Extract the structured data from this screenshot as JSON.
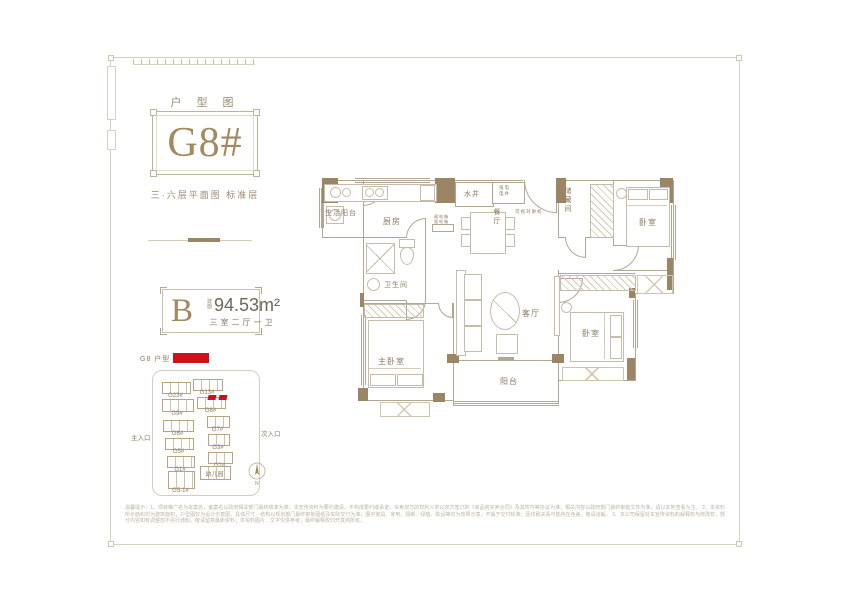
{
  "header": {
    "title": "户 型 图",
    "unit": "G8#",
    "subtitle": "三·六层平面图  标准层"
  },
  "info": {
    "type_letter": "B",
    "area_label_line1": "建",
    "area_label_line2": "面",
    "area_value": "94.53m²",
    "rooms_desc": "三室二厅一卫"
  },
  "colors": {
    "accent_red": "#d0101c",
    "wall_tan": "#9c8565",
    "gold": "#a3895e"
  },
  "siteplan": {
    "legend_label": "G8 户型",
    "entrance_left": "主入口",
    "entrance_right": "次入口",
    "compass": "N",
    "buildings": [
      {
        "label": "G23#",
        "x": 27,
        "y": 30,
        "w": 27,
        "h": 10
      },
      {
        "label": "G13#",
        "x": 58,
        "y": 27,
        "w": 28,
        "h": 10
      },
      {
        "label": "G9#",
        "x": 27,
        "y": 47,
        "w": 30,
        "h": 11
      },
      {
        "label": "G8#",
        "x": 62,
        "y": 45,
        "w": 27,
        "h": 10,
        "hl": true
      },
      {
        "label": "G6#",
        "x": 28,
        "y": 68,
        "w": 29,
        "h": 10
      },
      {
        "label": "G7#",
        "x": 72,
        "y": 64,
        "w": 21,
        "h": 10
      },
      {
        "label": "G5#",
        "x": 30,
        "y": 86,
        "w": 27,
        "h": 10
      },
      {
        "label": "G3#",
        "x": 73,
        "y": 82,
        "w": 20,
        "h": 10
      },
      {
        "label": "G1#",
        "x": 32,
        "y": 104,
        "w": 26,
        "h": 10
      },
      {
        "label": "G2#",
        "x": 73,
        "y": 100,
        "w": 23,
        "h": 10
      },
      {
        "label": "G5-1#",
        "x": 33,
        "y": 119,
        "w": 25,
        "h": 16
      },
      {
        "label": "幼儿园",
        "x": 65,
        "y": 114,
        "w": 29,
        "h": 12,
        "boxed": true
      }
    ]
  },
  "floorplan": {
    "labels": [
      {
        "text": "生活阳台",
        "x": 15,
        "y": 48,
        "fs": 7
      },
      {
        "text": "厨房",
        "x": 73,
        "y": 56,
        "fs": 8
      },
      {
        "text": "水井",
        "x": 154,
        "y": 29,
        "fs": 7
      },
      {
        "text": "强电",
        "x": 189,
        "y": 25,
        "fs": 4.5
      },
      {
        "text": "电井",
        "x": 189,
        "y": 31,
        "fs": 4.5
      },
      {
        "text": "可视对讲机",
        "x": 205,
        "y": 49,
        "fs": 4.5
      },
      {
        "text": "餐厅",
        "x": 181,
        "y": 48,
        "fs": 7,
        "v": true
      },
      {
        "text": "储藏间",
        "x": 252,
        "y": 27,
        "fs": 7,
        "v": true
      },
      {
        "text": "卧室",
        "x": 329,
        "y": 57,
        "fs": 8
      },
      {
        "text": "弱电箱",
        "x": 124,
        "y": 54,
        "fs": 4
      },
      {
        "text": "强电箱",
        "x": 124,
        "y": 59,
        "fs": 4
      },
      {
        "text": "卫生间",
        "x": 74,
        "y": 120,
        "fs": 7
      },
      {
        "text": "客厅",
        "x": 212,
        "y": 148,
        "fs": 8
      },
      {
        "text": "主卧室",
        "x": 68,
        "y": 196,
        "fs": 8
      },
      {
        "text": "卧室",
        "x": 272,
        "y": 168,
        "fs": 8
      },
      {
        "text": "阳台",
        "x": 190,
        "y": 216,
        "fs": 8
      }
    ]
  },
  "disclaimer": {
    "lines": [
      "温馨提示：1、项目推广名为本案名，备案名以政府相关部门最终核准为准；本宣传资料为要约邀请，不构成要约或承诺，买卖双方的权利义务以双方签订的《商品房买卖合同》及其附件等协议为准；相关内容以政府部门最终审批文件为准，请以实地查看为主。",
      "2、本资料所示面积均为建筑面积，户型图仅为设计示意图，具体尺寸、结构以规划部门最终审批图纸及实际交付为准；图中家具、家电、隔断、绿植、陈设等仅为效果示意，不属于交付标准；因印刷关系可能存在色差，敬请谅解。",
      "3、本公司保留对本宣传资料的解释权与修改权，部分内容如有调整恕不另行通知，敬请留意最新资料；本资料图片、文字仅供参考，最终解释权归开发商所有。"
    ]
  }
}
